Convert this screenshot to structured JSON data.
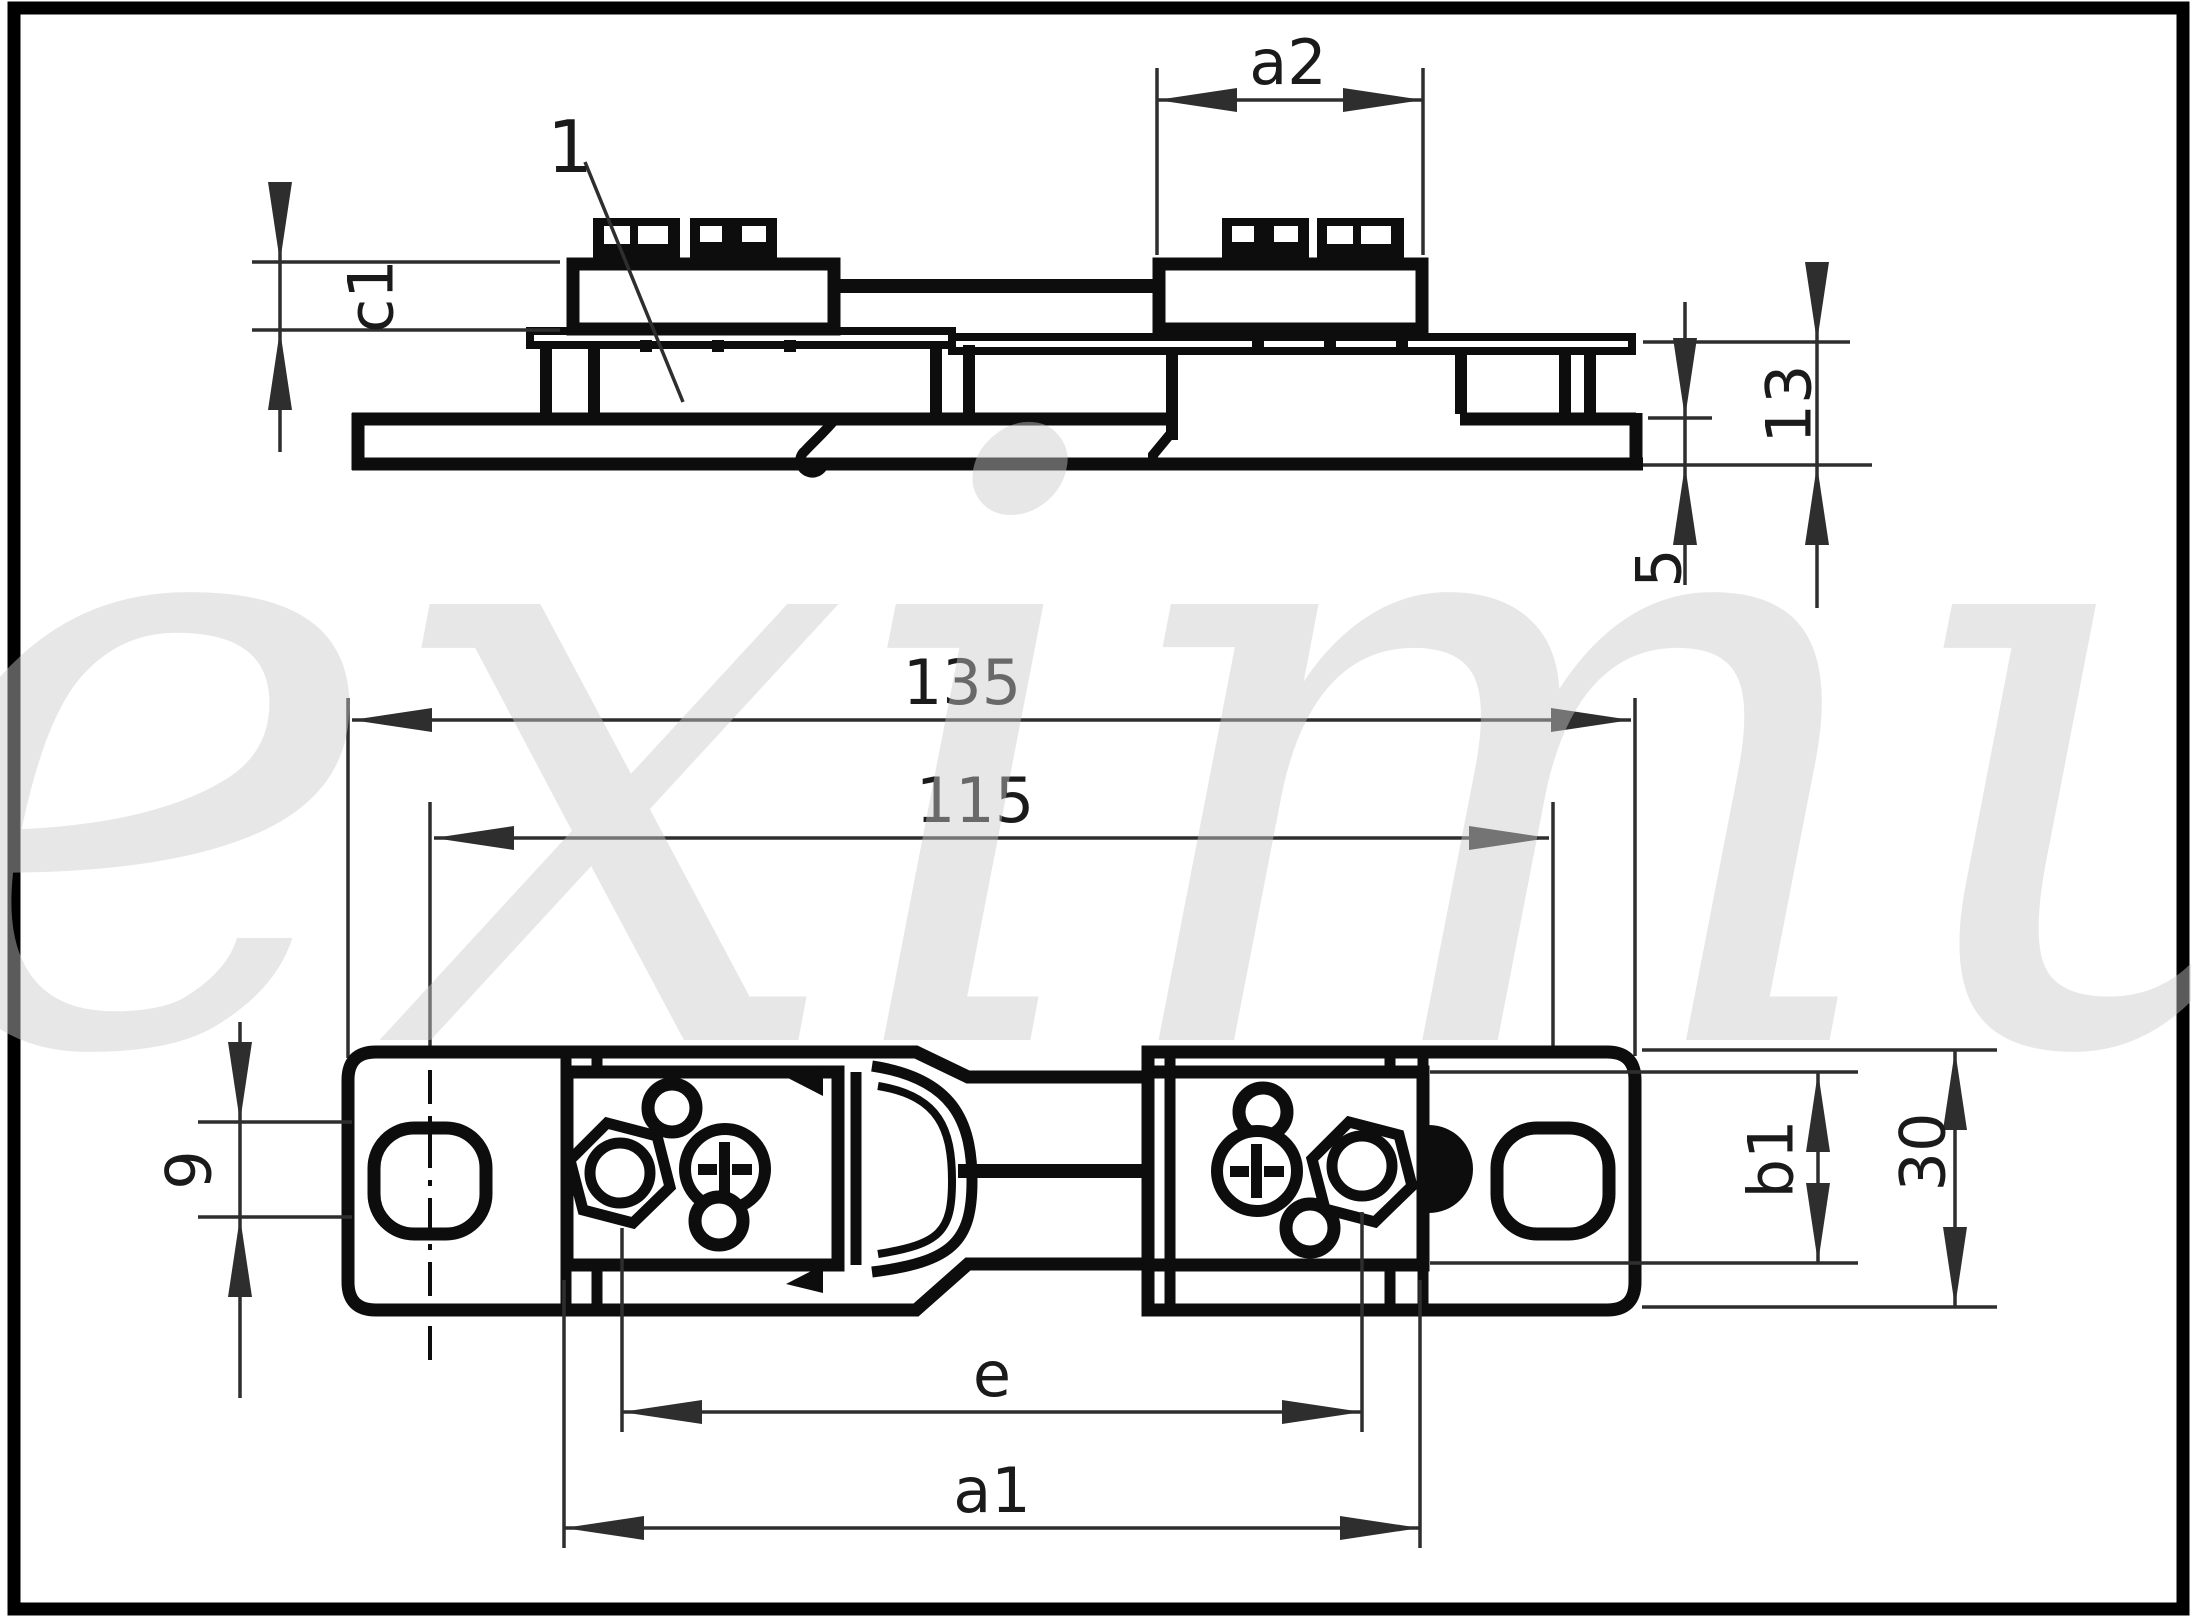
{
  "drawing": {
    "title_hint": "fuse holder technical drawing, two views with dimensions",
    "watermark": {
      "text": "eximus"
    },
    "labels": {
      "part_ref": "1",
      "c1": "c1",
      "a2": "a2",
      "h13": "13",
      "h5": "5",
      "len135": "135",
      "len115": "115",
      "w9": "9",
      "b1": "b1",
      "w30": "30",
      "e": "e",
      "a1": "a1"
    },
    "colors": {
      "background": "#ffffff",
      "part_line": "#0d0d0d",
      "dimension_line": "#2e2e2e",
      "text": "#1a1a1a",
      "watermark": "#c9c9c9",
      "frame": "#000000"
    }
  }
}
